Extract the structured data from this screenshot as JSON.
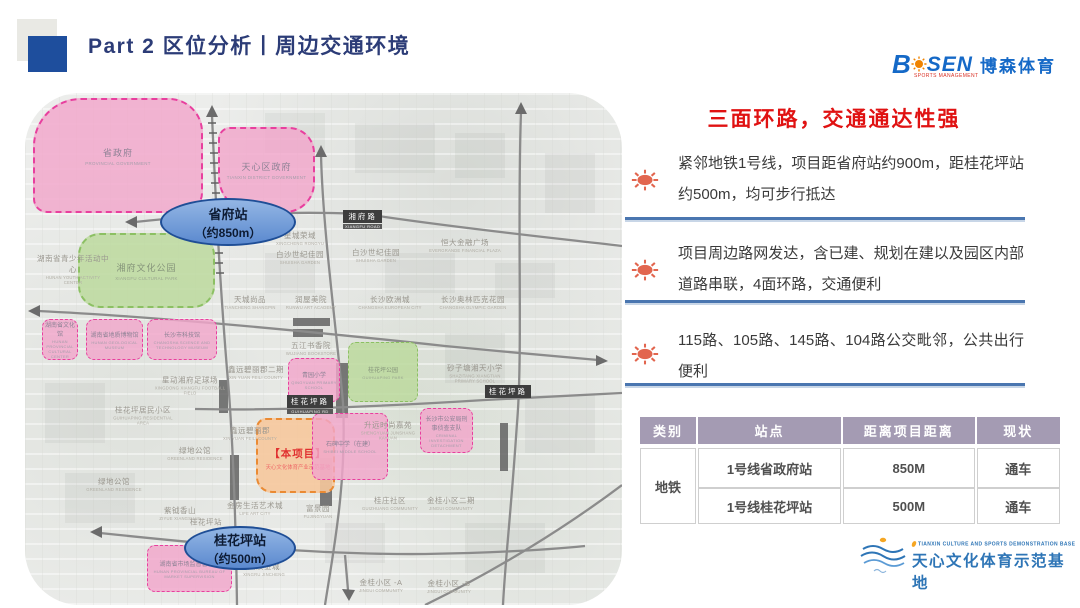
{
  "slide": {
    "title": "Part 2 区位分析丨周边交通环境"
  },
  "brand": {
    "name_b": "B",
    "name_rest": "SEN",
    "tagline": "SPORTS MANAGEMENT",
    "cn": "博森体育"
  },
  "panel": {
    "title": "三面环路，交通通达性强",
    "bullets": [
      {
        "text": "紧邻地铁1号线，项目距省府站约900m，距桂花坪站约500m，均可步行抵达"
      },
      {
        "text": "项目周边路网发达，含已建、规划在建以及园区内部道路串联，4面环路，交通便利"
      },
      {
        "text": "115路、105路、145路、104路公交毗邻，公共出行便利"
      }
    ]
  },
  "table": {
    "headers": [
      "类别",
      "站点",
      "距离项目距离",
      "现状"
    ],
    "category": "地铁",
    "rows": [
      {
        "station": "1号线省政府站",
        "distance": "850M",
        "status": "通车"
      },
      {
        "station": "1号线桂花坪站",
        "distance": "500M",
        "status": "通车"
      }
    ]
  },
  "footer": {
    "en": "TIANXIN CULTURE AND SPORTS DEMONSTRATION BASE",
    "cn": "天心文化体育示范基地"
  },
  "map": {
    "stations": [
      {
        "name": "省府站",
        "distance": "（约850m）"
      },
      {
        "name": "桂花坪站",
        "distance": "（约500m）"
      }
    ],
    "project": {
      "tag": "【本项目】",
      "name": "天心文化体育产业示范基地"
    },
    "zones": [
      {
        "cn": "省政府",
        "en": "PROVINCIAL GOVERNMENT"
      },
      {
        "cn": "天心区政府",
        "en": "TIANXIN DISTRICT GOVERNMENT"
      },
      {
        "cn": "湘府文化公园",
        "en": "XIANGFU CULTURAL PARK"
      },
      {
        "cn": "湖南省文化馆",
        "en": "HUNAN PROVINCIAL CULTURAL CENTER"
      },
      {
        "cn": "湖南省地质博物馆",
        "en": "HUNAN GEOLOGICAL MUSEUM"
      },
      {
        "cn": "长沙市科技馆",
        "en": "CHANGSHA SCIENCE AND TECHNOLOGY MUSEUM"
      },
      {
        "cn": "青园小学",
        "en": "QINGYUAN PRIMARY SCHOOL"
      },
      {
        "cn": "桂花坪公园",
        "en": "GUIHUAPING PARK"
      },
      {
        "cn": "长沙市公安局刑事侦查支队",
        "en": "CRIMINAL INVESTIGATION DETACHMENT"
      },
      {
        "cn": "石碑中学（在建）",
        "en": "SHIBEI MIDDLE SCHOOL"
      },
      {
        "cn": "湖南省市场监督管理局",
        "en": "HUNAN PROVINCIAL BUREAU OF MARKET SUPERVISION"
      }
    ],
    "road_labels": [
      {
        "cn": "湘府路",
        "en": "XIANGFU ROAD"
      },
      {
        "cn": "桂花坪路",
        "en": "GUIHUAPING RD"
      },
      {
        "cn": "桂花坪路",
        "en": ""
      }
    ],
    "labels": [
      {
        "cn": "湖南省青少年活动中心",
        "en": "HUNAN YOUTH ACTIVITY CENTER",
        "x": 48,
        "y": 176
      },
      {
        "cn": "星城荣域",
        "en": "XINGCHENG RONGYU",
        "x": 275,
        "y": 145
      },
      {
        "cn": "白沙世纪佳园",
        "en": "SHUISHA GARDEN",
        "x": 275,
        "y": 164
      },
      {
        "cn": "白沙世纪佳园",
        "en": "SHUISHA GARDEN",
        "x": 351,
        "y": 162
      },
      {
        "cn": "恒大金融广场",
        "en": "EVERGRANDE FINANCIAL PLAZA",
        "x": 440,
        "y": 152
      },
      {
        "cn": "天城尚品",
        "en": "TIANCHENG SHANGPIN",
        "x": 225,
        "y": 209
      },
      {
        "cn": "润屋美院",
        "en": "RUNWU ART ACADEMY",
        "x": 286,
        "y": 209
      },
      {
        "cn": "长沙欧洲城",
        "en": "CHANGSHA EUROPEAN CITY",
        "x": 365,
        "y": 209
      },
      {
        "cn": "长沙奥林匹克花园",
        "en": "CHANGSHA OLYMPIC GARDEN",
        "x": 448,
        "y": 209
      },
      {
        "cn": "五江书香院",
        "en": "WUJIANG BOOKSTORE",
        "x": 286,
        "y": 255
      },
      {
        "cn": "砂子塘湘天小学",
        "en": "SHAZITANG XIANGTIAN PRIMARY SCHOOL",
        "x": 450,
        "y": 280
      },
      {
        "cn": "星动湘府足球场",
        "en": "XINGDONG XIANGFU FOOTBALL FIELD",
        "x": 165,
        "y": 292
      },
      {
        "cn": "鑫远碧丽郡二期",
        "en": "XIN YUAN FEILI COUNTY",
        "x": 231,
        "y": 279
      },
      {
        "cn": "桂花坪居民小区",
        "en": "GUIHUAPING RESIDENTIAL AREA",
        "x": 118,
        "y": 322
      },
      {
        "cn": "升远时尚嘉苑",
        "en": "SHENGYUAN JUNSHANG KAYUAN",
        "x": 363,
        "y": 337
      },
      {
        "cn": "鑫远碧丽郡",
        "en": "XIN YUAN FEILI COUNTY",
        "x": 225,
        "y": 340
      },
      {
        "cn": "绿地公馆",
        "en": "GREENLAND RESIDENCE",
        "x": 170,
        "y": 360
      },
      {
        "cn": "绿地公馆",
        "en": "GREENLAND RESIDENCE",
        "x": 89,
        "y": 391
      },
      {
        "cn": "紫钺香山",
        "en": "ZIYUE XIANGSHAN",
        "x": 155,
        "y": 420
      },
      {
        "cn": "桂花坪站",
        "en": "",
        "x": 181,
        "y": 429
      },
      {
        "cn": "金房生活艺术城",
        "en": "LIFE ART CITY",
        "x": 230,
        "y": 415
      },
      {
        "cn": "兴汝金城",
        "en": "XINGRU JINCHENG",
        "x": 239,
        "y": 476
      },
      {
        "cn": "富景园",
        "en": "FUJINGYUAN",
        "x": 293,
        "y": 418
      },
      {
        "cn": "桂庄社区",
        "en": "GUIZHUANG COMMUNITY",
        "x": 365,
        "y": 410
      },
      {
        "cn": "金桂小区二期",
        "en": "JINGUI COMMUNITY",
        "x": 426,
        "y": 410
      },
      {
        "cn": "金桂小区 -A",
        "en": "JINGUI COMMUNITY",
        "x": 356,
        "y": 492
      },
      {
        "cn": "金桂小区 -B",
        "en": "JINGUI COMMUNITY",
        "x": 424,
        "y": 493
      }
    ]
  },
  "colors": {
    "title_navy": "#2c3c77",
    "accent_red": "#e01212",
    "divider_blue": "#4a76b0",
    "table_header": "#a49bb3",
    "brand_blue": "#1569c7",
    "footer_blue": "#2e75b6",
    "pink_zone": "#f2a6ca",
    "pink_border": "#e83f9e",
    "green_zone": "#bcd99e",
    "orange_zone": "#f6c89c",
    "station_blue": "#5b89cf",
    "sun_icon": "#e2654e"
  }
}
